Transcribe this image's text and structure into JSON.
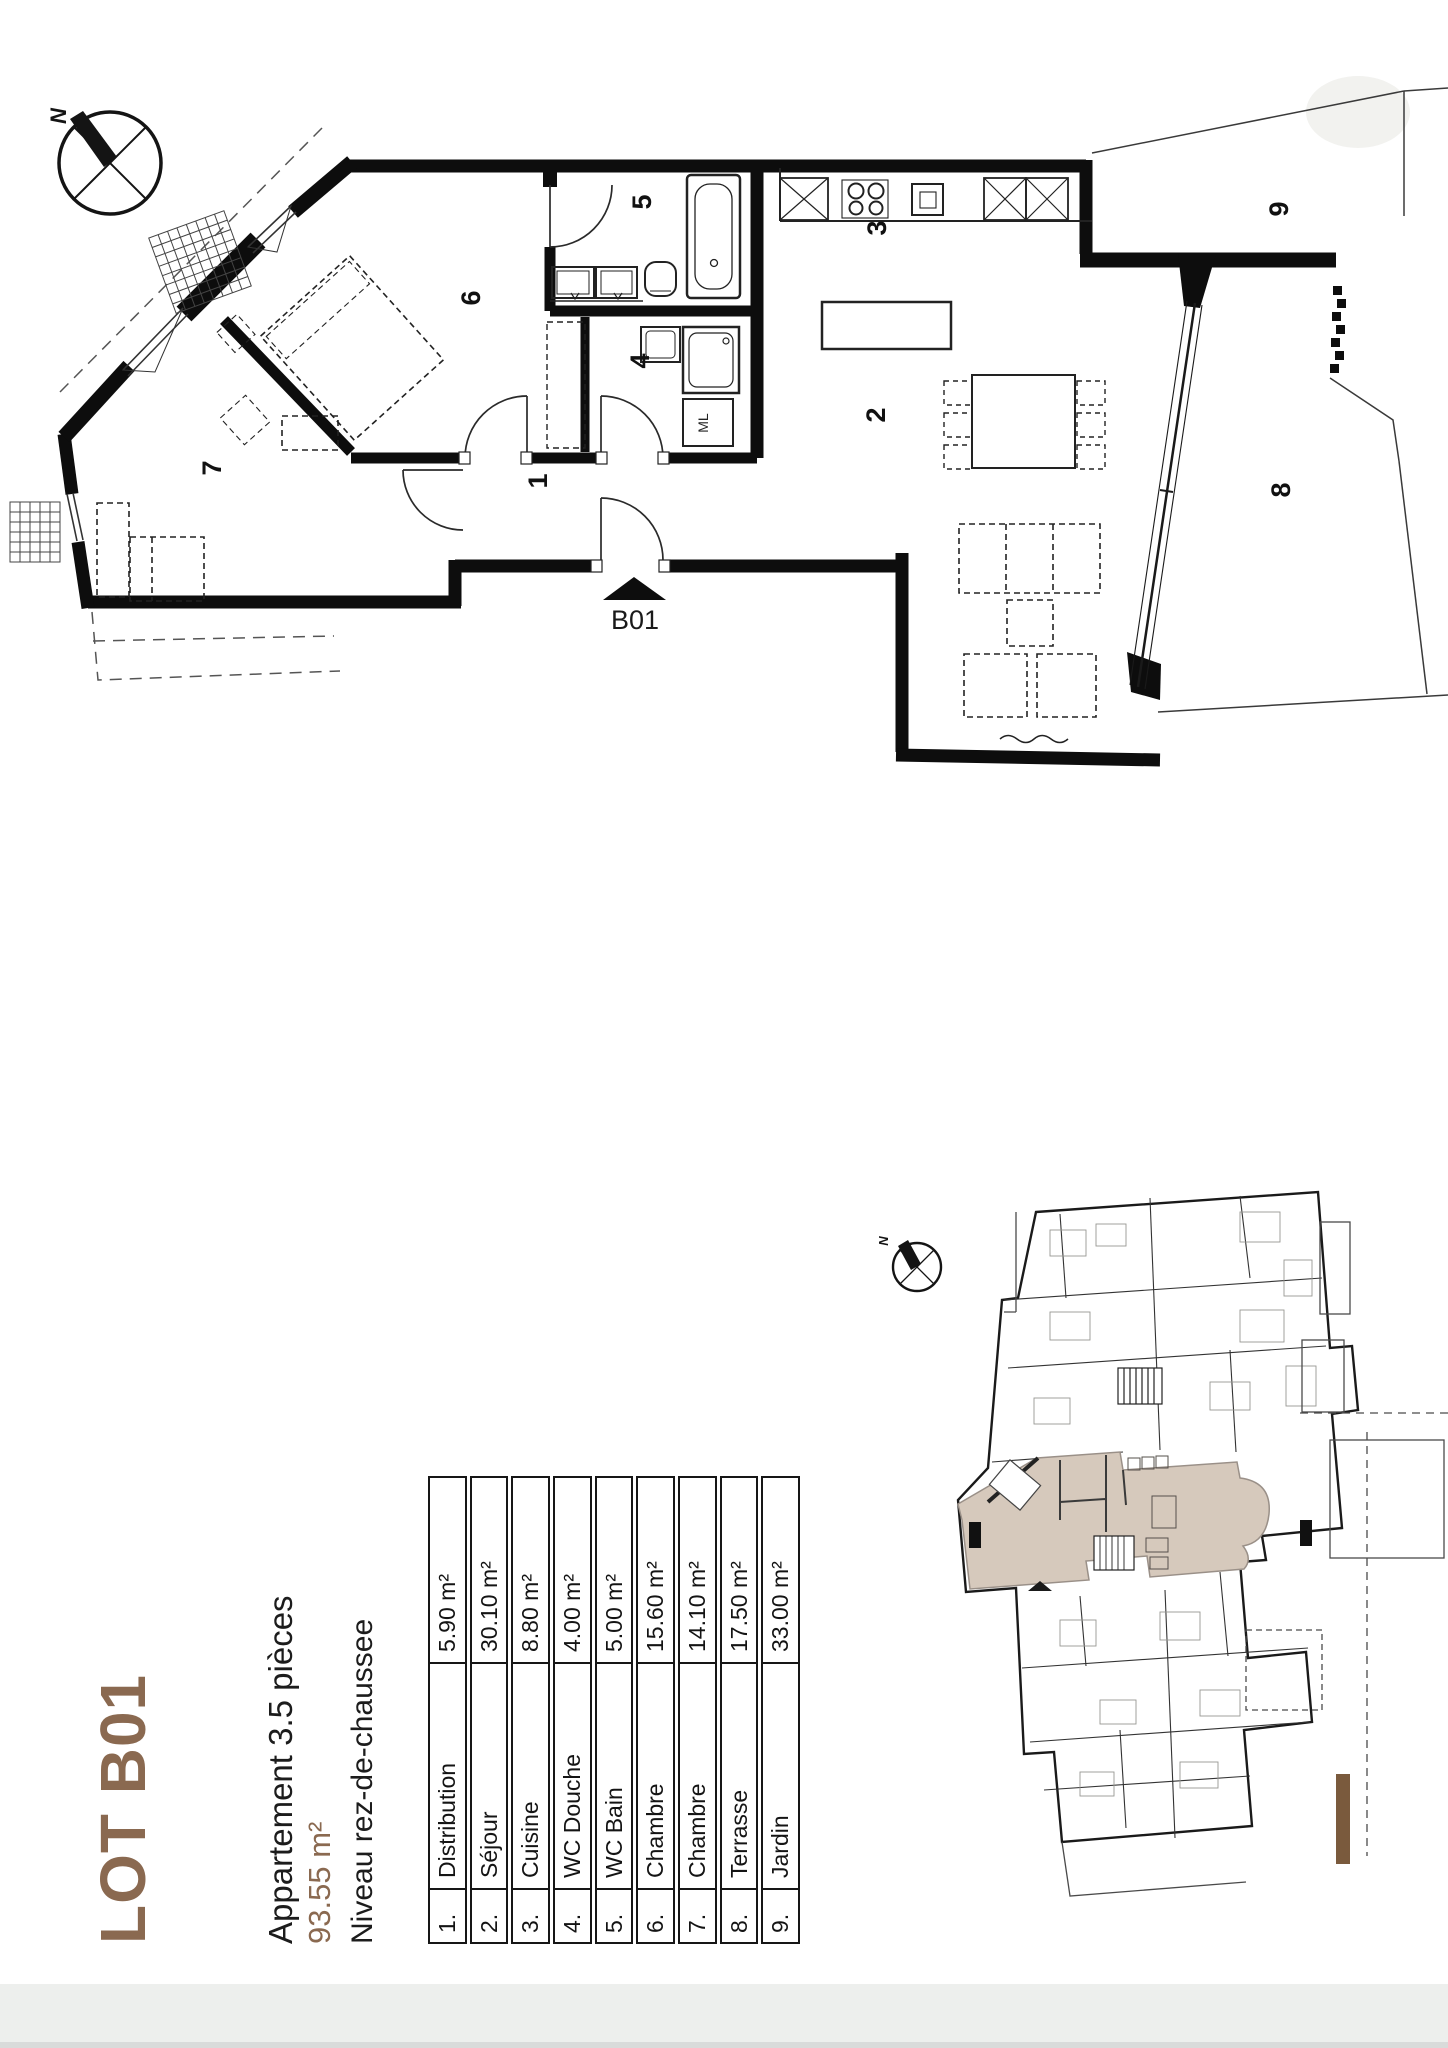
{
  "colors": {
    "accent_brown": "#8a6950",
    "unit_beige": "#d6c9bc",
    "wall_black": "#0d0d0d"
  },
  "title_block": {
    "lot": "LOT B01",
    "apartment_type": "Appartement 3.5 pièces",
    "total_area": "93.55 m²",
    "level": "Niveau rez-de-chaussee"
  },
  "entrance_label": "B01",
  "compass": {
    "north_label": "N"
  },
  "site_compass": {
    "north_label": "N"
  },
  "washer_label": "ML",
  "plan_numbers": {
    "n1": "1",
    "n2": "2",
    "n3": "3",
    "n4": "4",
    "n5": "5",
    "n6": "6",
    "n7": "7",
    "n8": "8",
    "n9": "9"
  },
  "legend_rows": [
    {
      "num": "1.",
      "name": "Distribution",
      "area": "5.90 m²"
    },
    {
      "num": "2.",
      "name": "Séjour",
      "area": "30.10 m²"
    },
    {
      "num": "3.",
      "name": "Cuisine",
      "area": "8.80 m²"
    },
    {
      "num": "4.",
      "name": "WC Douche",
      "area": "4.00 m²"
    },
    {
      "num": "5.",
      "name": "WC Bain",
      "area": "5.00 m²"
    },
    {
      "num": "6.",
      "name": "Chambre",
      "area": "15.60 m²"
    },
    {
      "num": "7.",
      "name": "Chambre",
      "area": "14.10 m²"
    },
    {
      "num": "8.",
      "name": "Terrasse",
      "area": "17.50 m²"
    },
    {
      "num": "9.",
      "name": "Jardin",
      "area": "33.00 m²"
    }
  ]
}
